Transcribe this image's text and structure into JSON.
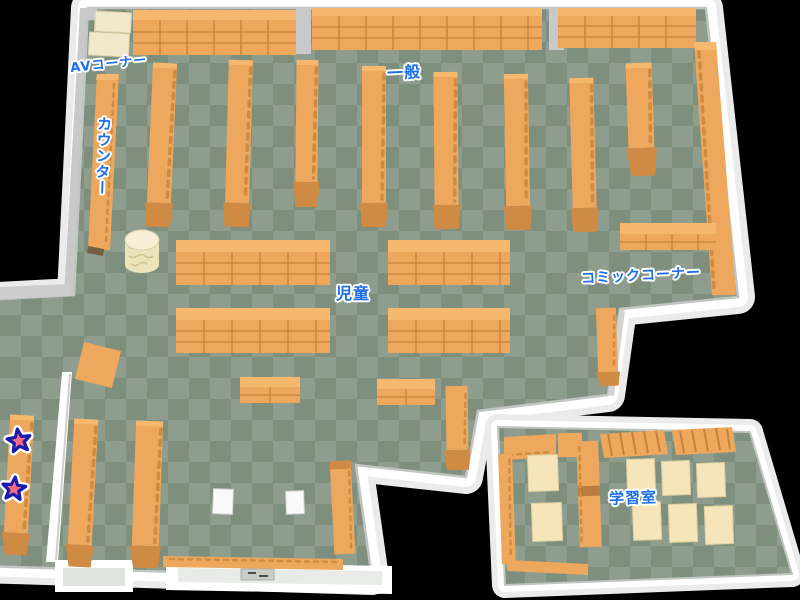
{
  "map": {
    "labels": {
      "av_corner": "AVコーナー",
      "counter": "カウンター",
      "general": "一般",
      "children": "児童",
      "comic_corner": "コミックコーナー",
      "study_room": "学習室"
    },
    "markers": [
      {
        "icon": "star-marker",
        "color": "#f26b7e"
      },
      {
        "icon": "star-marker",
        "color": "#f26b7e"
      }
    ],
    "palette": {
      "background": "#000000",
      "wall": "#ffffff",
      "wall_shadow": "#c9c9c9",
      "floor_light": "#8e9d8d",
      "floor_dark": "#7f8f7e",
      "shelf": "#eda85d",
      "shelf_top": "#f5b86e",
      "shelf_line": "#c5803c",
      "shelf_cap": "#cf8b44",
      "desk": "#f5e5b8",
      "label_text": "#1c6fe8",
      "star_fill": "#f26b7e",
      "star_outline": "#1a1aae"
    }
  }
}
